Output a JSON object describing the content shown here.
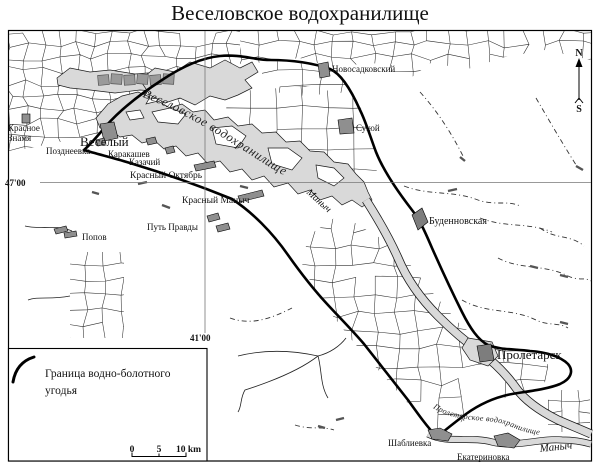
{
  "title": "Веселовское водохранилище",
  "compass": {
    "north": "N",
    "south": "S"
  },
  "graticule": {
    "lat_label": "47'00",
    "lon_label": "41'00"
  },
  "legend": {
    "line1": "Граница водно-болотного",
    "line2": "угодья"
  },
  "scalebar": {
    "tick0": "0",
    "tick5": "5",
    "tick10": "10 km"
  },
  "water_labels": {
    "reservoir": "Веселовское водохранилище",
    "manych_river": "Маныч",
    "manych_lower": "Маныч",
    "proletarsk_reservoir": "Пролетарское водохранилище"
  },
  "colors": {
    "water": "#d9d9d9",
    "marker": "#8f8f8f",
    "ink": "#000000"
  },
  "map": {
    "places": [
      {
        "id": "krasnoe-znamya",
        "lines": [
          "Красное",
          "Знамя"
        ],
        "x": 8,
        "y": 131,
        "fs": 9
      },
      {
        "id": "pozdneevka",
        "lines": [
          "Позднеевка"
        ],
        "x": 46,
        "y": 154,
        "fs": 9
      },
      {
        "id": "veselyi",
        "lines": [
          "Веселый"
        ],
        "x": 80,
        "y": 146,
        "fs": 13
      },
      {
        "id": "karakashev",
        "lines": [
          "Каракашев"
        ],
        "x": 108,
        "y": 157,
        "fs": 9
      },
      {
        "id": "kazachii",
        "lines": [
          "Казачий"
        ],
        "x": 129,
        "y": 165,
        "fs": 9
      },
      {
        "id": "krasnyi-oktyabr",
        "lines": [
          "Красный Октябрь"
        ],
        "x": 130,
        "y": 178,
        "fs": 9.5
      },
      {
        "id": "krasnyi-manych",
        "lines": [
          "Красный Маныч"
        ],
        "x": 182,
        "y": 203,
        "fs": 9.5
      },
      {
        "id": "put-pravdy",
        "lines": [
          "Путь Правды"
        ],
        "x": 147,
        "y": 230,
        "fs": 9
      },
      {
        "id": "popov",
        "lines": [
          "Попов"
        ],
        "x": 82,
        "y": 240,
        "fs": 9
      },
      {
        "id": "novosadkovskii",
        "lines": [
          "Новосадковский"
        ],
        "x": 332,
        "y": 72,
        "fs": 9
      },
      {
        "id": "sukhoi",
        "lines": [
          "Сухой"
        ],
        "x": 356,
        "y": 131,
        "fs": 9
      },
      {
        "id": "budennovskaya",
        "lines": [
          "Буденновская"
        ],
        "x": 429,
        "y": 224,
        "fs": 10
      },
      {
        "id": "proletarsk",
        "lines": [
          "Пролетарск"
        ],
        "x": 497,
        "y": 359,
        "fs": 13
      },
      {
        "id": "shablievka",
        "lines": [
          "Шаблиевка"
        ],
        "x": 388,
        "y": 446,
        "fs": 9
      },
      {
        "id": "ekaterinovka",
        "lines": [
          "Екатериновка"
        ],
        "x": 457,
        "y": 460,
        "fs": 9
      },
      {
        "id": "manych-lower",
        "lines": [
          "Маныч"
        ],
        "x": 540,
        "y": 452,
        "fs": 11,
        "it": true,
        "rot": -6
      },
      {
        "id": "manych-river",
        "lines": [
          "Маныч"
        ],
        "x": 306,
        "y": 193,
        "fs": 10,
        "it": true,
        "rot": 42
      }
    ]
  }
}
